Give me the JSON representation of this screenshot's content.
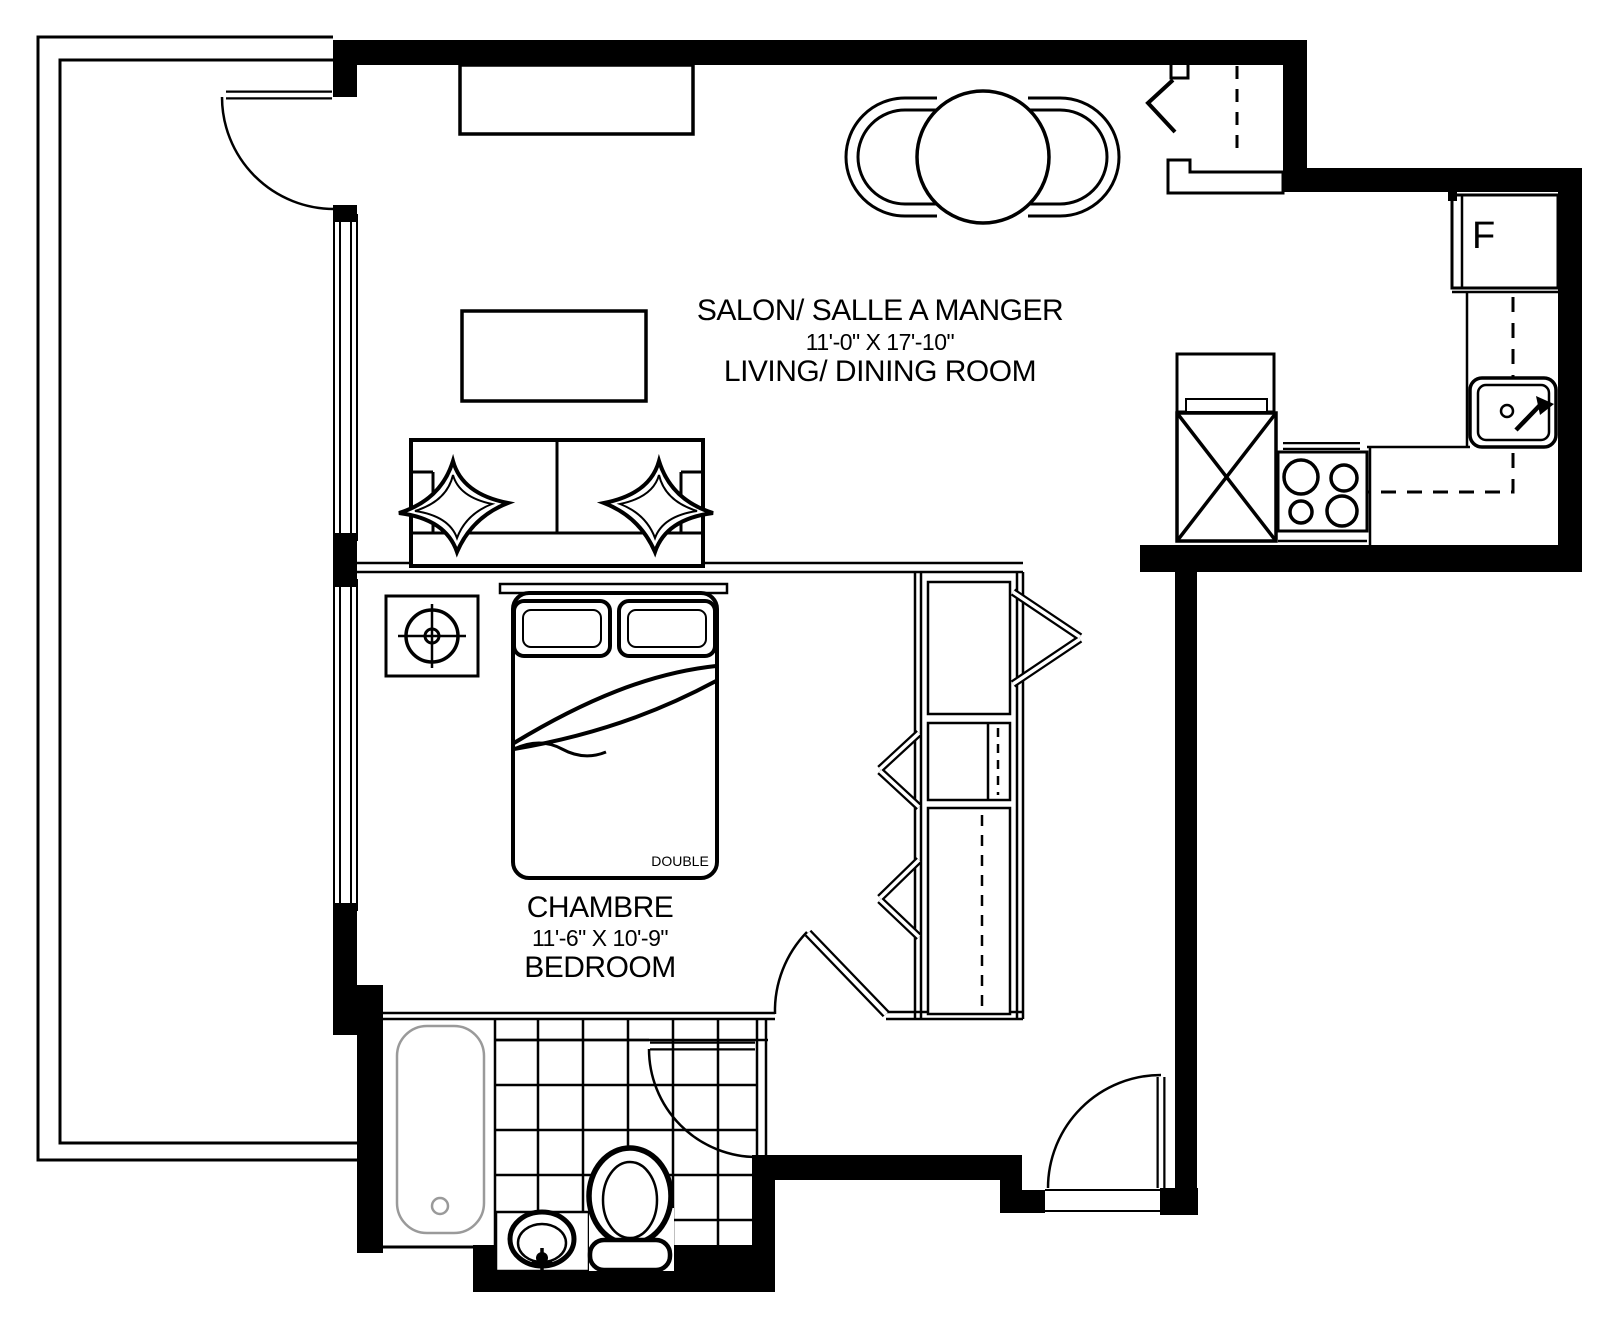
{
  "document": {
    "type": "apartment floor plan"
  },
  "rooms": {
    "living_dining": {
      "label_fr": "SALON/ SALLE A MANGER",
      "dimensions": "11'-0\" X 17'-10\"",
      "label_en": "LIVING/ DINING ROOM"
    },
    "bedroom": {
      "label_fr": "CHAMBRE",
      "dimensions": "11'-6\" X 10'-9\"",
      "label_en": "BEDROOM"
    }
  },
  "fixtures": {
    "bed_size_label": "DOUBLE",
    "fridge_label": "F"
  },
  "colors": {
    "line": "#000000",
    "background": "#ffffff",
    "tub_outline": "#9a9a9a"
  }
}
